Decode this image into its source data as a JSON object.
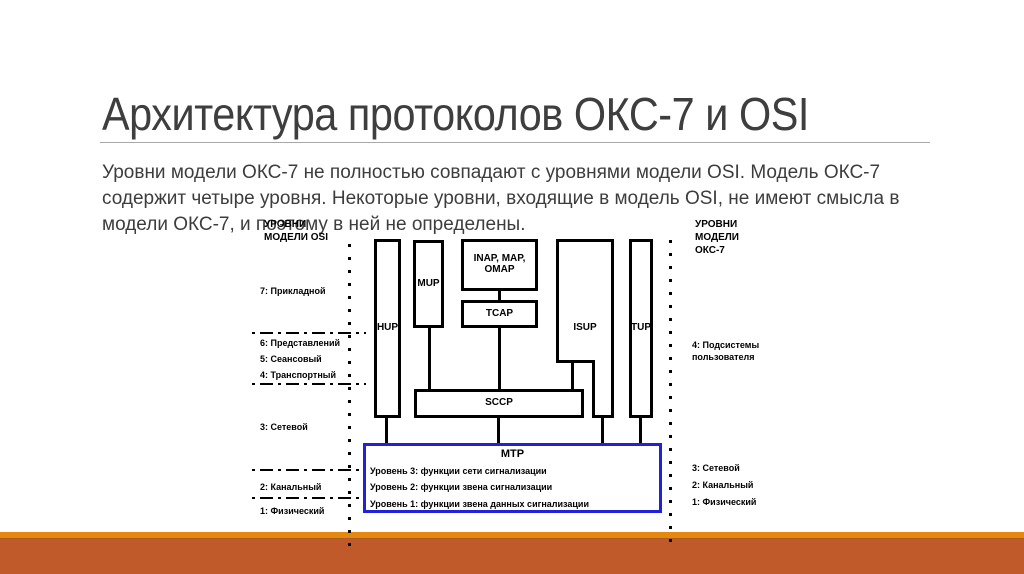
{
  "slide": {
    "title": "Архитектура протоколов ОКС-7 и OSI",
    "body": {
      "line1": "Уровни модели ОКС-7 не полностью совпадают с уровнями модели OSI. Модель ОКС-7",
      "line2": "содержит четыре уровня. Некоторые уровни, входящие в модель OSI, не имеют смысла в",
      "line3": "модели ОКС-7, и поэтому в ней не определены."
    }
  },
  "diagram": {
    "osi_header": {
      "line1": "УРОВНИ",
      "line2": "МОДЕЛИ OSI"
    },
    "osi_levels": {
      "l7": "7: Прикладной",
      "l6": "6: Представлений",
      "l5": "5: Сеансовый",
      "l4": "4: Транспортный",
      "l3": "3: Сетевой",
      "l2": "2: Канальный",
      "l1": "1: Физический"
    },
    "oks_header": {
      "line1": "УРОВНИ",
      "line2": "МОДЕЛИ",
      "line3": "ОКС-7"
    },
    "oks_levels": {
      "l4": "4: Подсистемы пользователя",
      "l3": "3: Сетевой",
      "l2": "2: Канальный",
      "l1": "1: Физический"
    },
    "boxes": {
      "hup": "HUP",
      "mup": "MUP",
      "inap_line1": "INAP, MAP,",
      "inap_line2": "OMAP",
      "tcap": "TCAP",
      "isup": "ISUP",
      "tup": "TUP",
      "sccp": "SCCP",
      "mtp": "МТР",
      "mtp_level3": "Уровень 3: функции сети сигнализации",
      "mtp_level2": "Уровень 2: функции звена сигнализации",
      "mtp_level1": "Уровень 1: функции звена данных сигнализации"
    }
  },
  "colors": {
    "footer_stripe_orange": "#E6880F",
    "footer_bar_rust": "#C05A2B",
    "mtp_border_blue": "#2121DB",
    "title_text": "#3E3E3E",
    "diagram_black": "#000000"
  }
}
